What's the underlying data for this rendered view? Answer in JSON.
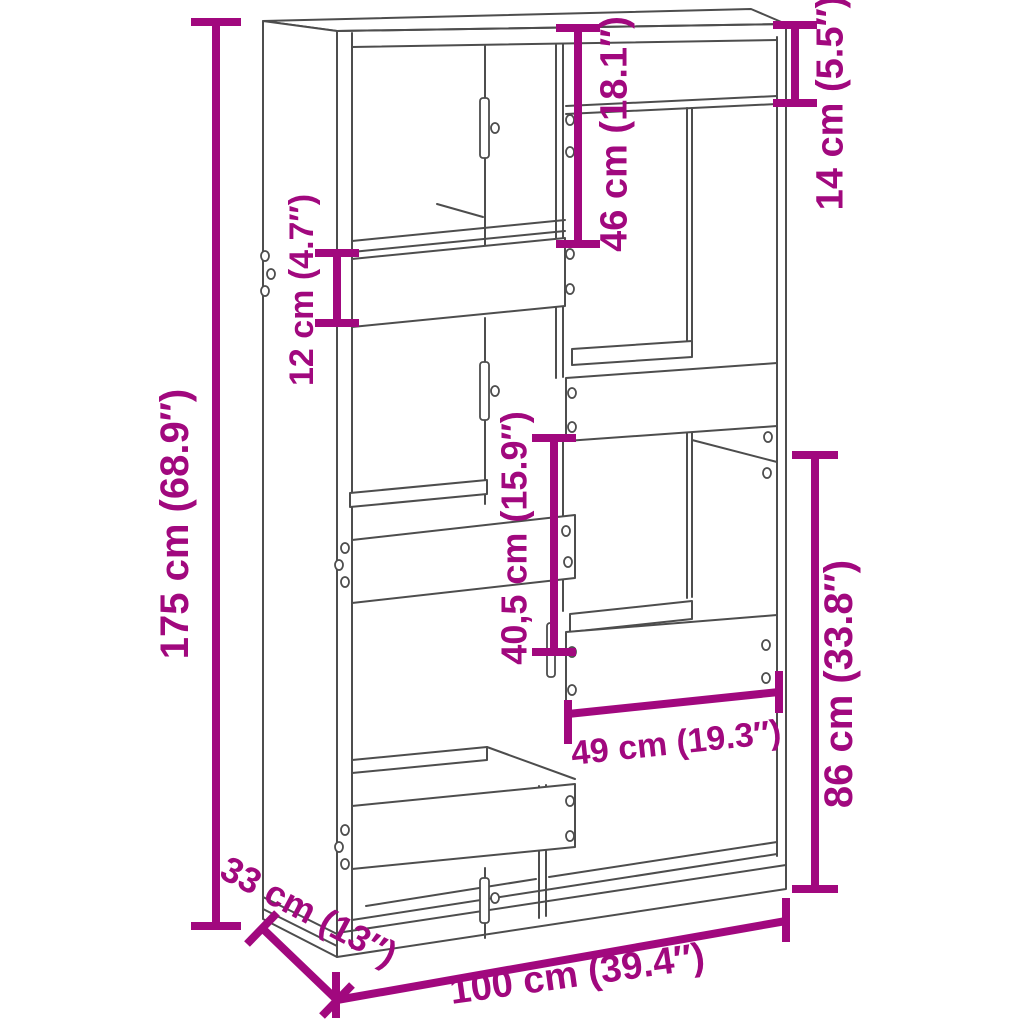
{
  "diagram": {
    "subject": "Bookcase room divider dimensional line drawing with staggered compartments",
    "background": "#FFFFFF",
    "accent_color": "#A1087E",
    "line_color": "#4D4D4D",
    "dims": {
      "h175": {
        "label": "175 cm (68.9″)",
        "cm": "175",
        "inches": "68.9″"
      },
      "h46": {
        "label": "46 cm (18.1″)",
        "cm": "46",
        "inches": "18.1″"
      },
      "h14": {
        "label": "14 cm (5.5″)",
        "cm": "14",
        "inches": "5.5″"
      },
      "h12": {
        "label": "12 cm (4.7″)",
        "cm": "12",
        "inches": "4.7″"
      },
      "h40_5": {
        "label": "40,5 cm (15.9″)",
        "cm": "40,5",
        "inches": "15.9″"
      },
      "h86": {
        "label": "86 cm (33.8″)",
        "cm": "86",
        "inches": "33.8″"
      },
      "w49": {
        "label": "49 cm (19.3″)",
        "cm": "49",
        "inches": "19.3″"
      },
      "d33": {
        "label": "33 cm (13″)",
        "cm": "33",
        "inches": "13″"
      },
      "w100": {
        "label": "100 cm (39.4″)",
        "cm": "100",
        "inches": "39.4″"
      }
    }
  }
}
